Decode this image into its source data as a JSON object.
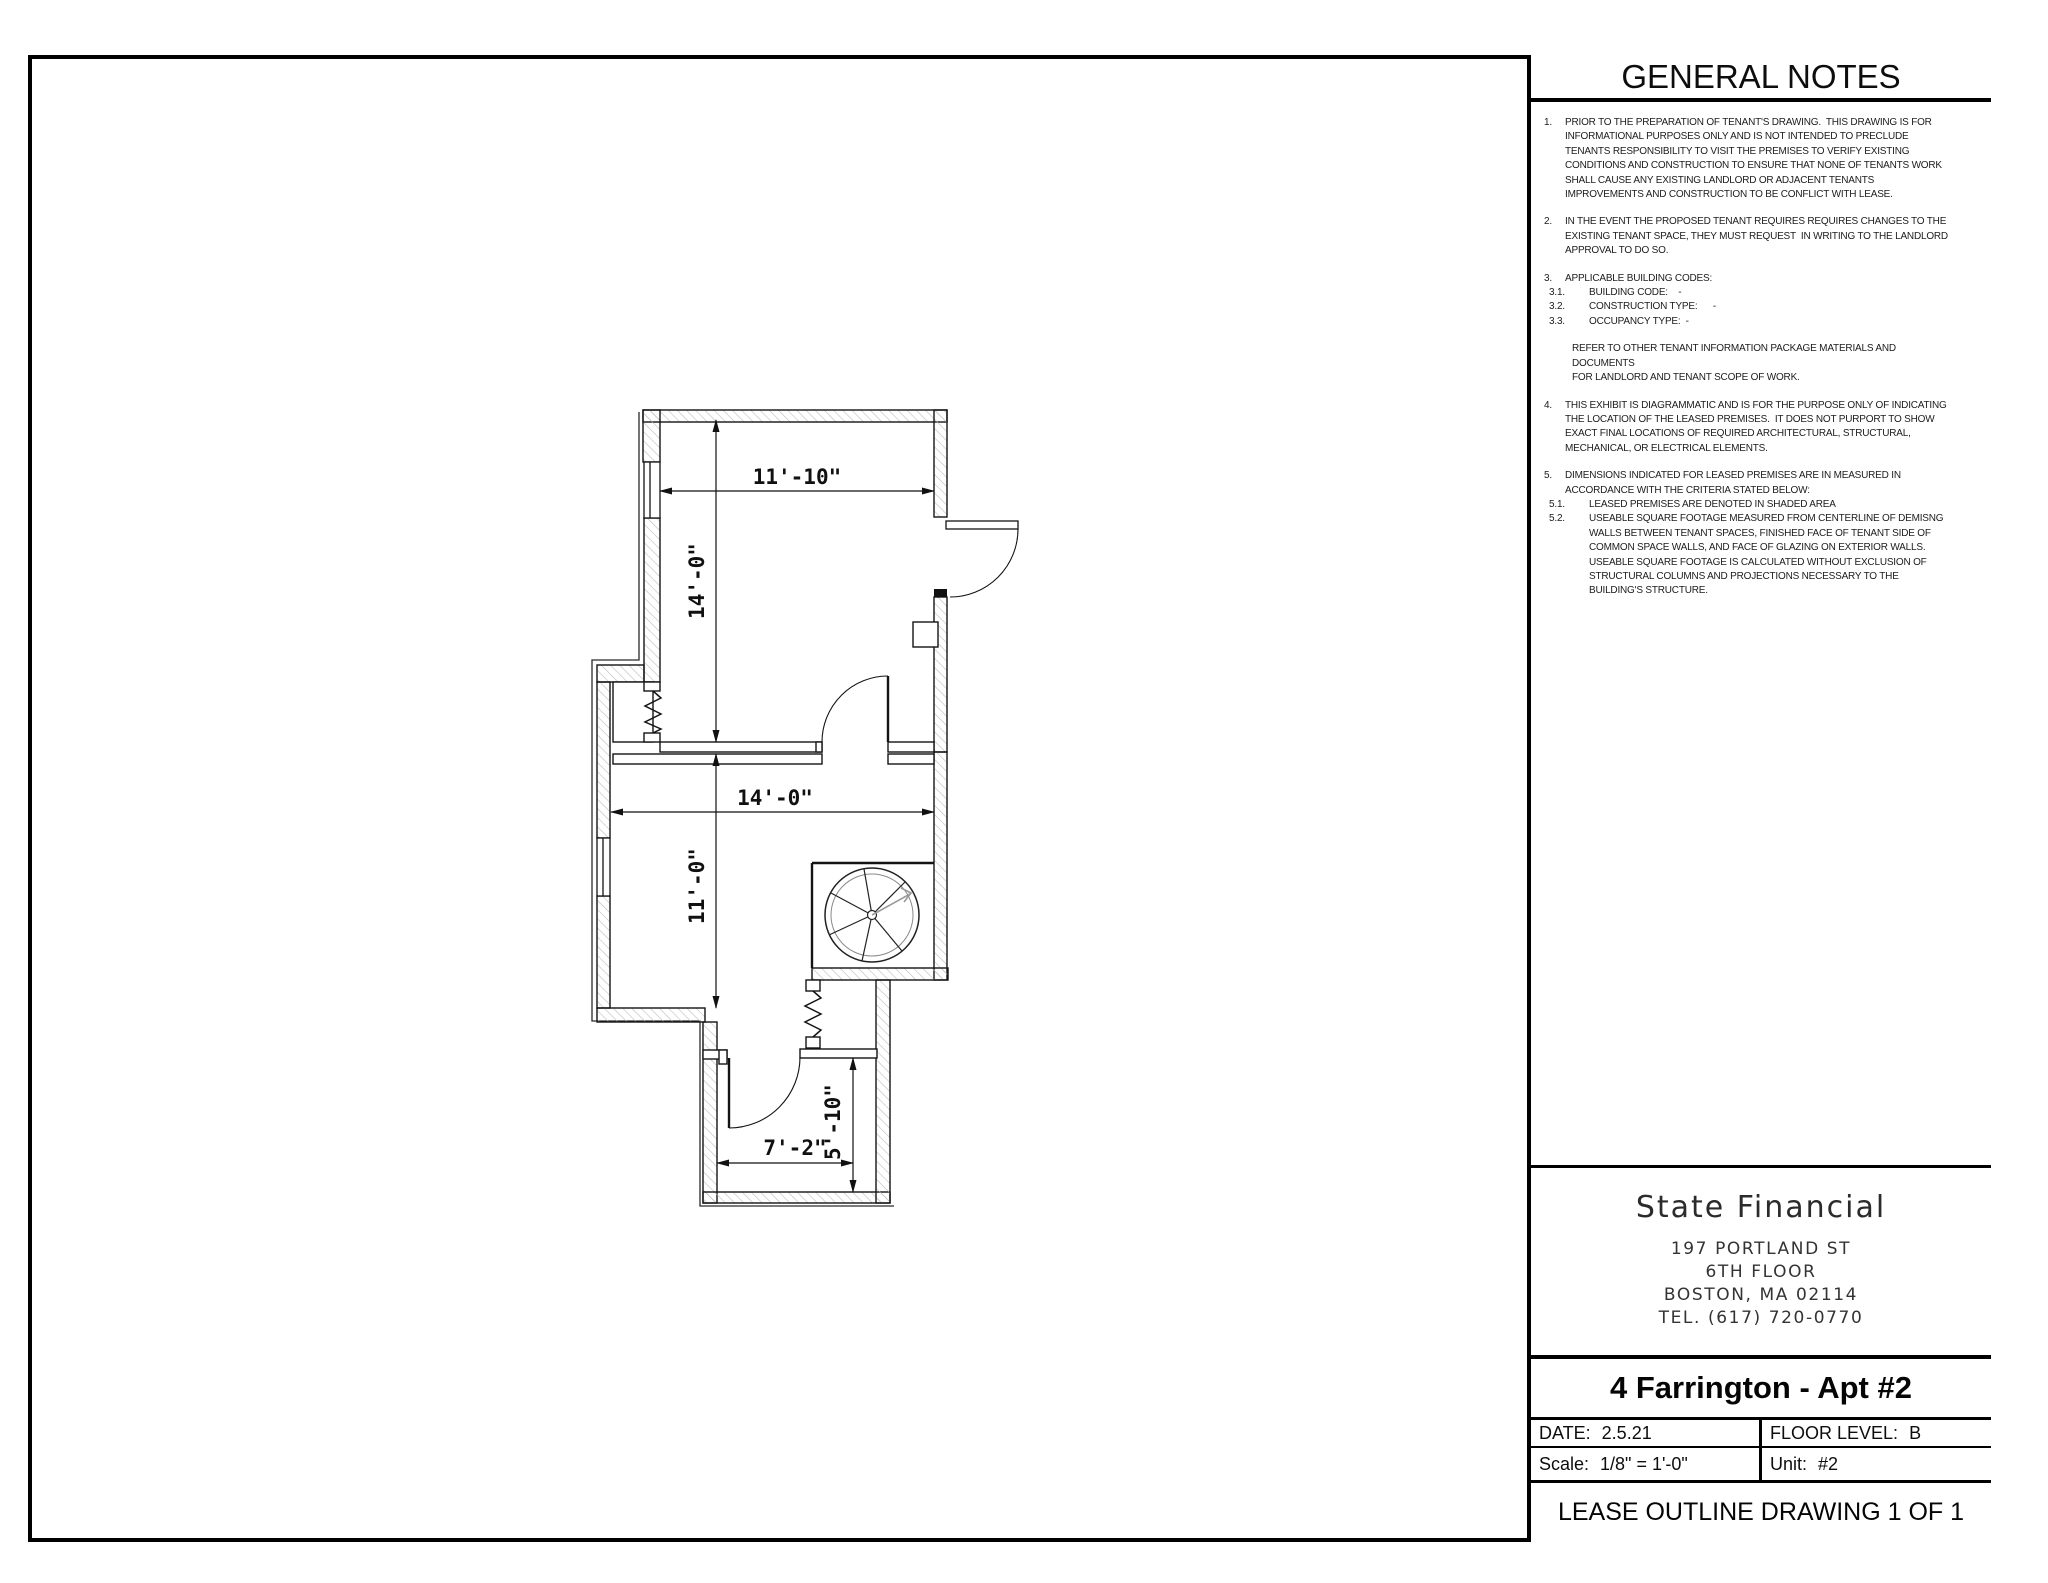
{
  "panel": {
    "header": "GENERAL NOTES",
    "notes": [
      {
        "num": "1.",
        "text": "PRIOR TO THE PREPARATION OF TENANT'S DRAWING.  THIS DRAWING IS FOR INFORMATIONAL PURPOSES ONLY AND IS NOT INTENDED TO PRECLUDE TENANTS RESPONSIBILITY TO VISIT THE PREMISES TO VERIFY EXISTING CONDITIONS AND CONSTRUCTION TO ENSURE THAT NONE OF TENANTS WORK SHALL CAUSE ANY EXISTING LANDLORD OR ADJACENT TENANTS IMPROVEMENTS AND CONSTRUCTION TO BE CONFLICT WITH LEASE."
      },
      {
        "num": "2.",
        "text": "IN THE EVENT THE PROPOSED TENANT REQUIRES REQUIRES CHANGES TO THE EXISTING TENANT SPACE, THEY MUST REQUEST  IN WRITING TO THE LANDLORD APPROVAL TO DO SO."
      },
      {
        "num": "3.",
        "text": "APPLICABLE BUILDING CODES:",
        "subs": [
          {
            "num": "3.1.",
            "text": "BUILDING CODE:    -"
          },
          {
            "num": "3.2.",
            "text": "CONSTRUCTION TYPE:      -"
          },
          {
            "num": "3.3.",
            "text": "OCCUPANCY TYPE:  -"
          }
        ],
        "extra": "REFER TO OTHER TENANT INFORMATION PACKAGE MATERIALS AND DOCUMENTS\nFOR LANDLORD AND TENANT SCOPE OF WORK."
      },
      {
        "num": "4.",
        "text": "THIS EXHIBIT IS DIAGRAMMATIC AND IS FOR THE PURPOSE ONLY OF INDICATING THE LOCATION OF THE LEASED PREMISES.  IT DOES NOT PURPORT TO SHOW EXACT FINAL LOCATIONS OF REQUIRED ARCHITECTURAL, STRUCTURAL, MECHANICAL, OR ELECTRICAL ELEMENTS."
      },
      {
        "num": "5.",
        "text": "DIMENSIONS INDICATED FOR LEASED PREMISES ARE IN MEASURED IN ACCORDANCE WITH THE CRITERIA STATED BELOW:",
        "subs": [
          {
            "num": "5.1.",
            "text": "LEASED PREMISES ARE DENOTED IN SHADED AREA"
          },
          {
            "num": "5.2.",
            "text": "USEABLE SQUARE FOOTAGE MEASURED FROM CENTERLINE OF DEMISNG WALLS BETWEEN TENANT SPACES, FINISHED FACE OF TENANT SIDE OF COMMON SPACE WALLS, AND FACE OF GLAZING ON EXTERIOR WALLS.  USEABLE SQUARE FOOTAGE IS CALCULATED WITHOUT EXCLUSION OF STRUCTURAL COLUMNS AND PROJECTIONS NECESSARY TO THE BUILDING'S STRUCTURE."
          }
        ]
      }
    ]
  },
  "company": {
    "name": "State Financial",
    "address1": "197 PORTLAND ST",
    "address2": "6TH FLOOR",
    "address3": "BOSTON, MA 02114",
    "phone": "TEL. (617) 720-0770"
  },
  "title_block": {
    "project": "4 Farrington - Apt #2",
    "date_label": "DATE:",
    "date_value": "2.5.21",
    "floor_label": "FLOOR LEVEL:",
    "floor_value": "B",
    "scale_label": "Scale:",
    "scale_value": "1/8\" = 1'-0\"",
    "unit_label": "Unit:",
    "unit_value": "#2",
    "sheet_title": "LEASE OUTLINE DRAWING 1 OF 1"
  },
  "plan": {
    "dims": {
      "upper_width": "11'-10\"",
      "upper_height": "14'-0\"",
      "mid_width": "14'-0\"",
      "mid_height": "11'-0\"",
      "lower_width": "7'-2\"",
      "lower_height": "5'-10\""
    }
  }
}
